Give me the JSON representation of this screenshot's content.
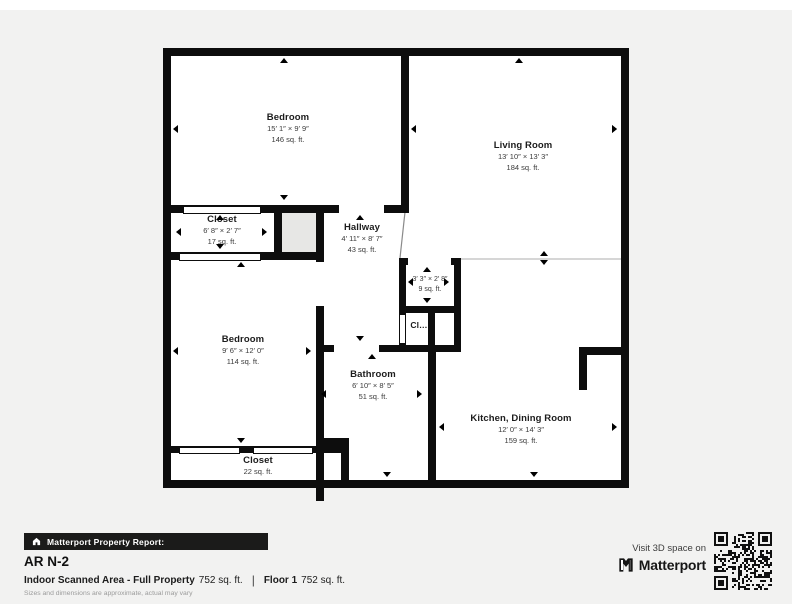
{
  "floorplan": {
    "rooms": {
      "bedroom1": {
        "name": "Bedroom",
        "dims": "15′ 1″ × 9′ 9″",
        "area": "146 sq. ft."
      },
      "living": {
        "name": "Living Room",
        "dims": "13′ 10″ × 13′ 3″",
        "area": "184 sq. ft."
      },
      "closet_upper": {
        "name": "Closet",
        "dims": "6′ 8″ × 2′ 7″",
        "area": "17 sq. ft."
      },
      "hallway": {
        "name": "Hallway",
        "dims": "4′ 11″ × 8′ 7″",
        "area": "43 sq. ft."
      },
      "closet_small": {
        "dims": "3′ 3″ × 2′ 8″",
        "area": "9 sq. ft."
      },
      "closet_truncated": {
        "name": "Cl…"
      },
      "bedroom2": {
        "name": "Bedroom",
        "dims": "9′ 6″ × 12′ 0″",
        "area": "114 sq. ft."
      },
      "bathroom": {
        "name": "Bathroom",
        "dims": "6′ 10″ × 8′ 5″",
        "area": "51 sq. ft."
      },
      "kitchen": {
        "name": "Kitchen, Dining Room",
        "dims": "12′ 0″ × 14′ 3″",
        "area": "159 sq. ft."
      },
      "closet_lower": {
        "name": "Closet",
        "area": "22 sq. ft."
      }
    }
  },
  "footer": {
    "report_bar_label": "Matterport Property Report:",
    "title": "AR N-2",
    "stats": {
      "label1": "Indoor Scanned Area - Full Property",
      "value1": "752 sq. ft.",
      "separator": "|",
      "label2": "Floor 1",
      "value2": "752 sq. ft."
    },
    "disclaimer": "Sizes and dimensions are approximate, actual may vary",
    "visit_cta": "Visit 3D space on",
    "brand": "Matterport"
  },
  "colors": {
    "wall": "#0d0d0d",
    "background_panel": "#f2f2f1",
    "report_bar_bg": "#1b1b1a",
    "unscanned_gray": "#e7e7e5"
  }
}
